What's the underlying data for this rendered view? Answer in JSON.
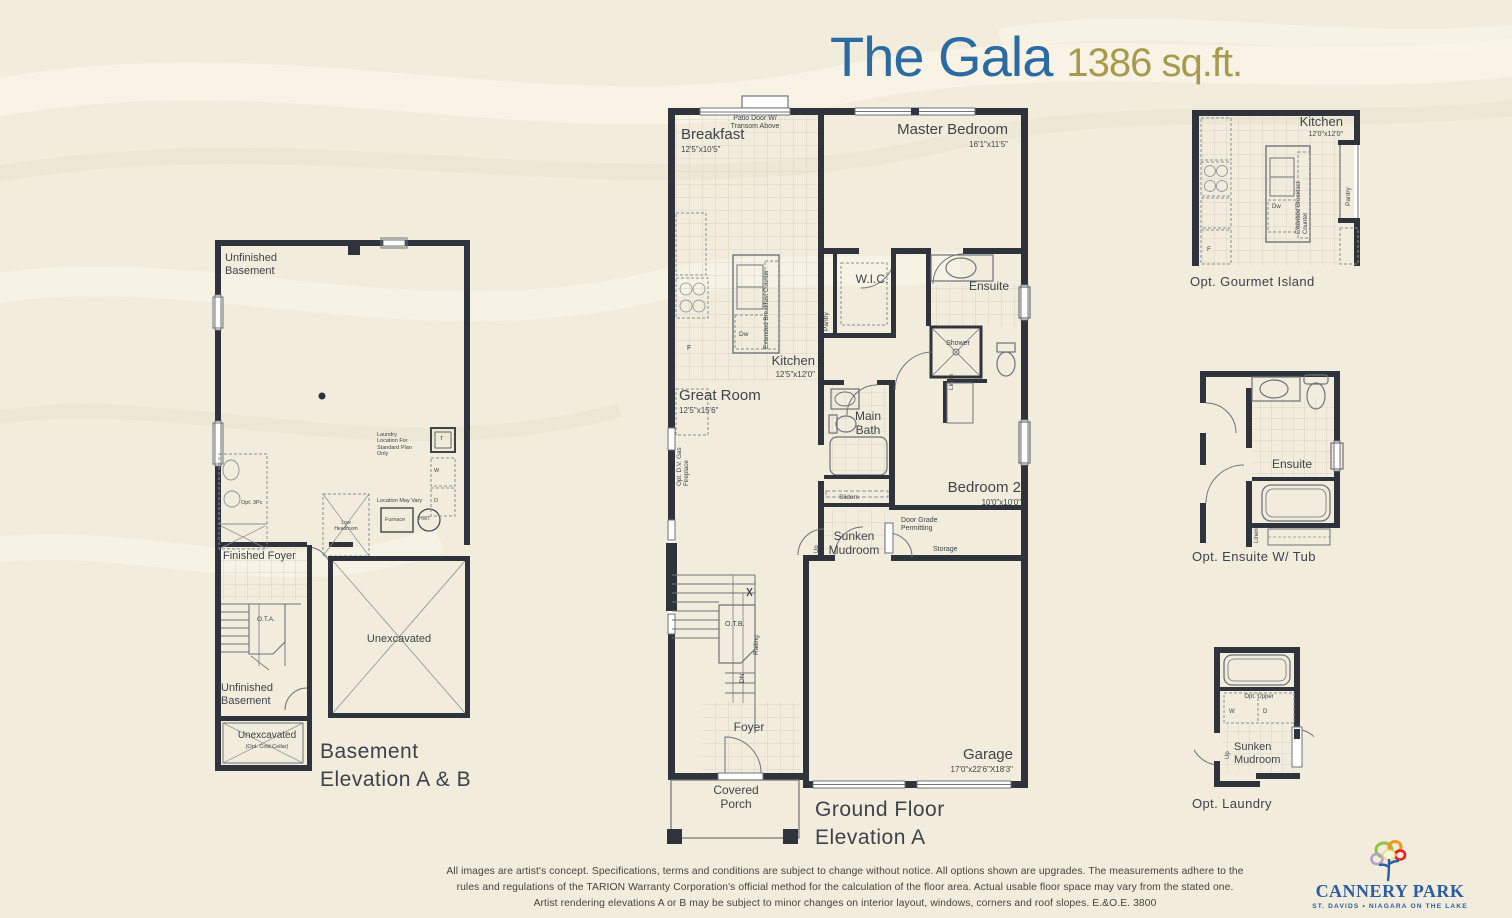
{
  "header": {
    "title": "The Gala",
    "sqft": "1386 sq.ft."
  },
  "colors": {
    "background": "#f1ecdb",
    "wall": "#2e333c",
    "title_blue": "#2a6ba3",
    "sqft_gold": "#a89a4d",
    "logo_blue": "#2b5da3",
    "label_gray": "#3f444b"
  },
  "plans": {
    "ground": {
      "caption": "Ground Floor\nElevation A",
      "labels": [
        {
          "name": "patio-door-note",
          "text": "Patio Door W/\nTransom Above",
          "x": 52,
          "y": 22,
          "w": 80,
          "size": 7,
          "align": "center"
        },
        {
          "name": "breakfast-label",
          "text": "Breakfast",
          "x": 18,
          "y": 33,
          "size": 15
        },
        {
          "name": "breakfast-dims",
          "text": "12'5\"x10'5\"",
          "x": 18,
          "y": 52,
          "size": 8
        },
        {
          "name": "master-bedroom-label",
          "text": "Master Bedroom",
          "x": 205,
          "y": 28,
          "w": 140,
          "size": 15,
          "align": "right"
        },
        {
          "name": "master-bedroom-dims",
          "text": "16'1\"x11'5\"",
          "x": 205,
          "y": 47,
          "w": 140,
          "size": 8,
          "align": "right"
        },
        {
          "name": "wic-label",
          "text": "W.I.C.",
          "x": 184,
          "y": 179,
          "w": 50,
          "size": 12,
          "align": "center"
        },
        {
          "name": "pantry-label",
          "text": "Pantry",
          "x": 160,
          "y": 238,
          "size": 6.5,
          "rotate": -90
        },
        {
          "name": "ensuite-label",
          "text": "Ensuite",
          "x": 295,
          "y": 186,
          "w": 62,
          "size": 12,
          "align": "center"
        },
        {
          "name": "shower-label",
          "text": "Shower",
          "x": 272,
          "y": 247,
          "w": 46,
          "size": 7,
          "align": "center"
        },
        {
          "name": "linen-label",
          "text": "Linen",
          "x": 285,
          "y": 297,
          "size": 6.5,
          "rotate": -90
        },
        {
          "name": "kitchen-label",
          "text": "Kitchen",
          "x": 72,
          "y": 260,
          "w": 80,
          "size": 13,
          "align": "right"
        },
        {
          "name": "kitchen-dims",
          "text": "12'5\"x12'0\"",
          "x": 72,
          "y": 277,
          "w": 80,
          "size": 8,
          "align": "right"
        },
        {
          "name": "dw-label",
          "text": "Dw",
          "x": 76,
          "y": 238,
          "size": 6.5
        },
        {
          "name": "extended-counter-label",
          "text": "Extended Breakfast Counter",
          "x": 100,
          "y": 256,
          "size": 6.3,
          "rotate": -90
        },
        {
          "name": "fridge-label",
          "text": "F",
          "x": 24,
          "y": 252,
          "size": 7
        },
        {
          "name": "great-room-label",
          "text": "Great Room",
          "x": 16,
          "y": 294,
          "size": 15
        },
        {
          "name": "great-room-dims",
          "text": "12'5\"x15'6\"",
          "x": 16,
          "y": 313,
          "size": 8
        },
        {
          "name": "fireplace-label",
          "text": "Opt. D.V. Gas\nFireplace",
          "x": 13,
          "y": 393,
          "size": 6.3,
          "rotate": -90
        },
        {
          "name": "main-bath-label",
          "text": "Main\nBath",
          "x": 182,
          "y": 316,
          "w": 46,
          "size": 12,
          "align": "center"
        },
        {
          "name": "sliders-label",
          "text": "Sliders",
          "x": 165,
          "y": 401,
          "w": 42,
          "size": 6.5,
          "align": "center"
        },
        {
          "name": "bedroom2-label",
          "text": "Bedroom 2",
          "x": 230,
          "y": 386,
          "w": 128,
          "size": 15,
          "align": "right"
        },
        {
          "name": "bedroom2-dims",
          "text": "10'0\"x10'0\"",
          "x": 230,
          "y": 405,
          "w": 128,
          "size": 8,
          "align": "right"
        },
        {
          "name": "door-grade-note",
          "text": "Door Grade\nPermitting",
          "x": 238,
          "y": 424,
          "size": 7
        },
        {
          "name": "storage-label",
          "text": "Storage",
          "x": 270,
          "y": 453,
          "size": 7
        },
        {
          "name": "mudroom-label",
          "text": "Sunken\nMudroom",
          "x": 160,
          "y": 436,
          "w": 62,
          "size": 12,
          "align": "center"
        },
        {
          "name": "up-label",
          "text": "Up",
          "x": 151,
          "y": 460,
          "size": 6,
          "rotate": -90
        },
        {
          "name": "otb-label",
          "text": "O.T.B.",
          "x": 62,
          "y": 528,
          "size": 7
        },
        {
          "name": "railing-label",
          "text": "Railing",
          "x": 90,
          "y": 562,
          "size": 6.5,
          "rotate": -90
        },
        {
          "name": "dn-label",
          "text": "DN",
          "x": 76,
          "y": 590,
          "size": 6.5,
          "rotate": -90
        },
        {
          "name": "foyer-label",
          "text": "Foyer",
          "x": 60,
          "y": 627,
          "w": 52,
          "size": 12,
          "align": "center"
        },
        {
          "name": "covered-porch-label",
          "text": "Covered\nPorch",
          "x": 38,
          "y": 690,
          "w": 70,
          "size": 12,
          "align": "center"
        },
        {
          "name": "garage-label",
          "text": "Garage",
          "x": 240,
          "y": 653,
          "w": 110,
          "size": 15,
          "align": "right"
        },
        {
          "name": "garage-dims",
          "text": "17'0\"x22'6\"X18'3\"",
          "x": 240,
          "y": 672,
          "w": 110,
          "size": 8,
          "align": "right"
        }
      ]
    },
    "basement": {
      "caption": "Basement\nElevation A & B",
      "labels": [
        {
          "name": "unfinished-basement-label",
          "text": "Unfinished\nBasement",
          "x": 14,
          "y": 16,
          "size": 11
        },
        {
          "name": "laundry-note",
          "text": "Laundry\nLocation For\nStandard Plan\nOnly",
          "x": 166,
          "y": 196,
          "size": 5.5
        },
        {
          "name": "laundry-tub-label",
          "text": "T",
          "x": 229,
          "y": 200,
          "size": 5.5
        },
        {
          "name": "washer-label",
          "text": "W",
          "x": 223,
          "y": 232,
          "size": 5.5
        },
        {
          "name": "dryer-label",
          "text": "D",
          "x": 223,
          "y": 262,
          "size": 5.5
        },
        {
          "name": "location-vary-note",
          "text": "Location May Vary",
          "x": 166,
          "y": 262,
          "size": 5.5
        },
        {
          "name": "furnace-label",
          "text": "Furnace",
          "x": 174,
          "y": 281,
          "size": 5.5
        },
        {
          "name": "hwt-label",
          "text": "HWT",
          "x": 208,
          "y": 281,
          "size": 5
        },
        {
          "name": "opt-3pc-label",
          "text": "Opt. 3Pc",
          "x": 30,
          "y": 264,
          "size": 5.5
        },
        {
          "name": "low-headroom-label",
          "text": "Low\nHeadroom",
          "x": 112,
          "y": 285,
          "w": 46,
          "size": 5,
          "align": "center"
        },
        {
          "name": "finished-foyer-label",
          "text": "Finished Foyer",
          "x": 12,
          "y": 314,
          "size": 11
        },
        {
          "name": "ota-label",
          "text": "O.T.A.",
          "x": 46,
          "y": 380,
          "size": 6.5
        },
        {
          "name": "unexcavated-label",
          "text": "Unexcavated",
          "x": 128,
          "y": 397,
          "w": 120,
          "size": 11,
          "align": "center"
        },
        {
          "name": "unfinished-basement2-label",
          "text": "Unfinished\nBasement",
          "x": 10,
          "y": 446,
          "size": 11
        },
        {
          "name": "unexcavated-cold-label",
          "text": "Unexcavated",
          "x": 18,
          "y": 494,
          "w": 76,
          "size": 10,
          "align": "center"
        },
        {
          "name": "cold-cellar-note",
          "text": "(Opt. Cold Cellar)",
          "x": 18,
          "y": 508,
          "w": 76,
          "size": 5.5,
          "align": "center"
        }
      ]
    },
    "island": {
      "caption": "Opt. Gourmet Island",
      "labels": [
        {
          "name": "kitchen-opt-label",
          "text": "Kitchen",
          "x": 51,
          "y": 8,
          "w": 102,
          "size": 13,
          "align": "right"
        },
        {
          "name": "kitchen-opt-dims",
          "text": "12'0\"x12'0\"",
          "x": 51,
          "y": 25,
          "w": 102,
          "size": 7,
          "align": "right"
        },
        {
          "name": "pantry-opt-label",
          "text": "Pantry",
          "x": 155,
          "y": 100,
          "size": 6.5,
          "rotate": -90
        },
        {
          "name": "dw-opt-label",
          "text": "Dw",
          "x": 82,
          "y": 98,
          "size": 6
        },
        {
          "name": "extended-counter-opt-label",
          "text": "Extended Breakfast Counter",
          "x": 106,
          "y": 128,
          "size": 6,
          "rotate": -90
        },
        {
          "name": "fridge-opt-label",
          "text": "F",
          "x": 17,
          "y": 140,
          "size": 6.5
        }
      ]
    },
    "ensuite": {
      "caption": "Opt. Ensuite W/ Tub",
      "labels": [
        {
          "name": "ensuite-opt-label",
          "text": "Ensuite",
          "x": 62,
          "y": 94,
          "w": 72,
          "size": 12,
          "align": "center"
        },
        {
          "name": "linen-opt-label",
          "text": "Linen",
          "x": 60,
          "y": 180,
          "size": 6,
          "rotate": -90
        }
      ]
    },
    "laundry": {
      "caption": "Opt. Laundry",
      "labels": [
        {
          "name": "opt-upper-label",
          "text": "Opt. Upper",
          "x": 31,
          "y": 51,
          "w": 68,
          "size": 6,
          "align": "center"
        },
        {
          "name": "washer-opt-label",
          "text": "W",
          "x": 35,
          "y": 66,
          "size": 6
        },
        {
          "name": "dryer-opt-label",
          "text": "D",
          "x": 69,
          "y": 66,
          "size": 6
        },
        {
          "name": "up-opt-label",
          "text": "Up",
          "x": 31,
          "y": 116,
          "size": 6,
          "rotate": -90
        },
        {
          "name": "mudroom-opt-label",
          "text": "Sunken\nMudroom",
          "x": 40,
          "y": 98,
          "size": 11
        }
      ]
    }
  },
  "footer": {
    "disclaimer": "All images are artist's concept. Specifications, terms and conditions are subject to change without notice. All options shown are upgrades. The measurements adhere to the\nrules and regulations of the TARION Warranty Corporation's official method for the calculation of the floor area. Actual usable floor space may vary from the stated one.\nArtist rendering elevations A or B may be subject to minor changes on interior layout, windows, corners and roof slopes. E.&O.E.  3800"
  },
  "logo": {
    "name": "CANNERY PARK",
    "tagline": "ST. DAVIDS • NIAGARA ON THE LAKE"
  }
}
